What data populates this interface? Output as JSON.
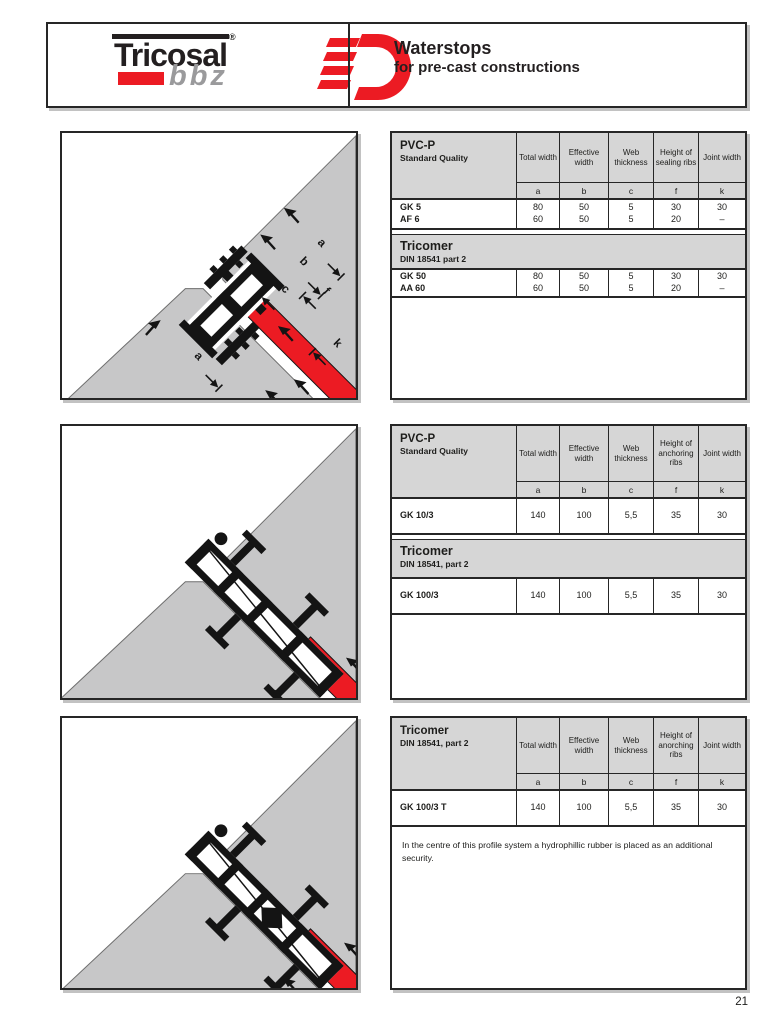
{
  "header": {
    "logo_brand": "Tricosal",
    "logo_reg": "®",
    "logo_sub": "bbz",
    "title": "Waterstops",
    "subtitle": "for pre-cast constructions"
  },
  "page_number": "21",
  "colors": {
    "accent_red": "#ec1b23",
    "concrete_gray": "#c7c7c8",
    "table_header_gray": "#d6d6d6",
    "border_dark": "#262626"
  },
  "diagrams": [
    {
      "name": "pvc-p-corner-joint-detail",
      "dim_labels": [
        "a",
        "b",
        "f",
        "c",
        "k",
        "a"
      ]
    },
    {
      "name": "gk-100-3-corner-joint-detail",
      "dim_labels": []
    },
    {
      "name": "gk-100-3-t-corner-joint-detail",
      "dim_labels": []
    }
  ],
  "tables": [
    {
      "head_title": "PVC-P",
      "head_subtitle": "Standard Quality",
      "columns": [
        "Total width",
        "Effective width",
        "Web thickness",
        "Height of sealing ribs",
        "Joint width"
      ],
      "letters": [
        "a",
        "b",
        "c",
        "f",
        "k"
      ],
      "row1_label": "GK 5\nAF 6",
      "row1_values": [
        "80\n60",
        "50\n50",
        "5\n5",
        "30\n20",
        "30\n–"
      ],
      "band_title": "Tricomer",
      "band_subtitle": "DIN 18541 part 2",
      "row2_label": "GK 50\nAA 60",
      "row2_values": [
        "80\n60",
        "50\n50",
        "5\n5",
        "30\n20",
        "30\n–"
      ]
    },
    {
      "head_title": "PVC-P",
      "head_subtitle": "Standard Quality",
      "columns": [
        "Total width",
        "Effective width",
        "Web thickness",
        "Height of anchoring ribs",
        "Joint width"
      ],
      "letters": [
        "a",
        "b",
        "c",
        "f",
        "k"
      ],
      "row1_label": "GK 10/3",
      "row1_values": [
        "140",
        "100",
        "5,5",
        "35",
        "30"
      ],
      "band_title": "Tricomer",
      "band_subtitle": "DIN 18541, part 2",
      "row2_label": "GK 100/3",
      "row2_values": [
        "140",
        "100",
        "5,5",
        "35",
        "30"
      ]
    },
    {
      "head_title": "Tricomer",
      "head_subtitle": "DIN 18541, part 2",
      "columns": [
        "Total width",
        "Effective width",
        "Web thickness",
        "Height of anorching ribs",
        "Joint width"
      ],
      "letters": [
        "a",
        "b",
        "c",
        "f",
        "k"
      ],
      "row1_label": "GK 100/3 T",
      "row1_values": [
        "140",
        "100",
        "5,5",
        "35",
        "30"
      ],
      "note": "In the centre of this profile system a hydrophillic rubber is placed as an additional security."
    }
  ]
}
